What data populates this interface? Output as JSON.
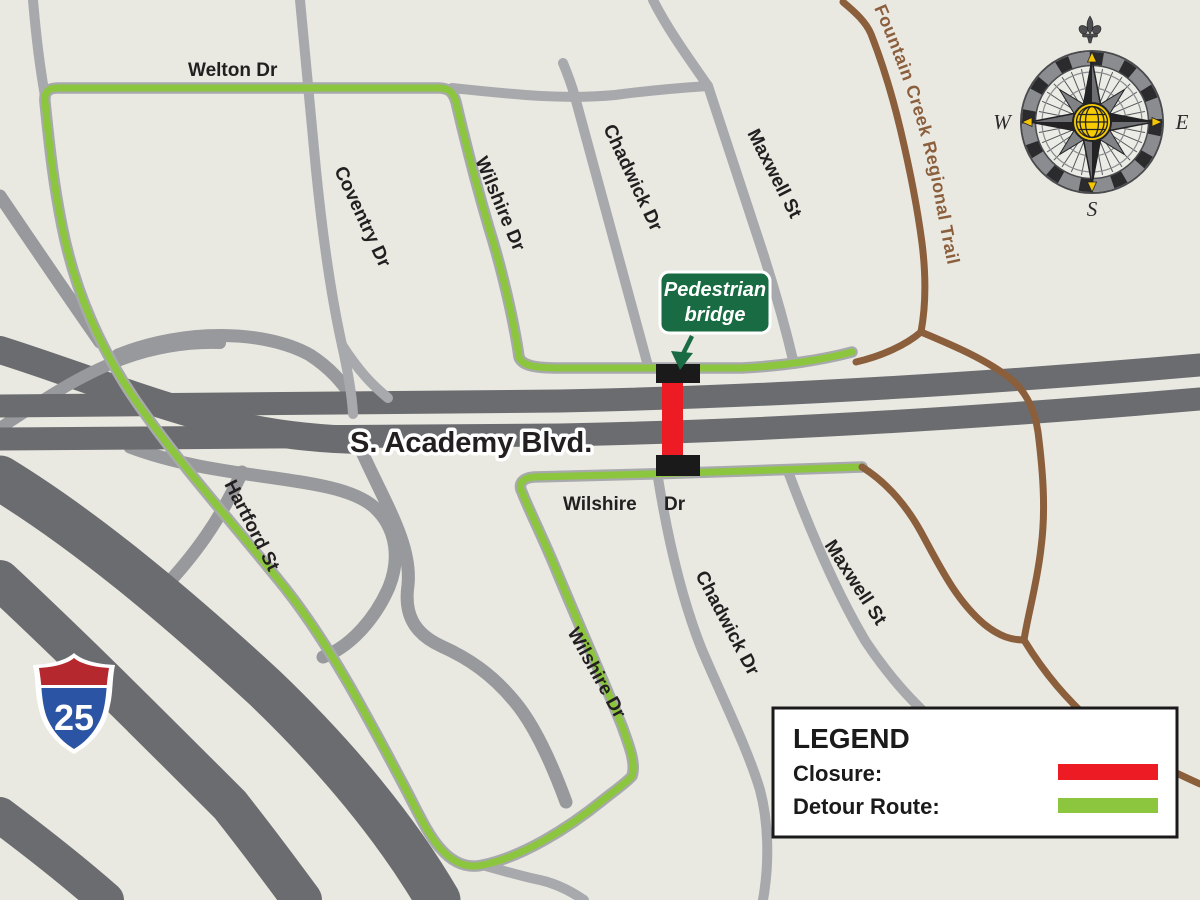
{
  "map": {
    "colors": {
      "background": "#E9E9E2",
      "road_major": "#6B6C6F",
      "road_minor": "#A7A9AC",
      "road_ramp": "#97999C",
      "closure_red": "#ED1C24",
      "detour_green": "#8CC63E",
      "trail_brown": "#8B5E3C",
      "callout_green": "#186B42",
      "bridge_black": "#1A1A1A"
    },
    "labels": {
      "welton": "Welton Dr",
      "coventry": "Coventry Dr",
      "wilshire_north": "Wilshire Dr",
      "chadwick_north": "Chadwick Dr",
      "maxwell_north": "Maxwell St",
      "academy": "S. Academy Blvd.",
      "hartford": "Hartford St",
      "wilshire_frontage": "Wilshire Dr",
      "wilshire_south": "Wilshire Dr",
      "chadwick_south": "Chadwick Dr",
      "maxwell_south": "Maxwell St",
      "trail": "Fountain Creek Regional Trail"
    },
    "callout": {
      "line1": "Pedestrian",
      "line2": "bridge"
    },
    "shield": {
      "number": "25"
    },
    "compass": {
      "west": "W",
      "east": "E",
      "south": "S"
    },
    "legend": {
      "title": "LEGEND",
      "closure_label": "Closure:",
      "detour_label": "Detour Route:"
    }
  }
}
